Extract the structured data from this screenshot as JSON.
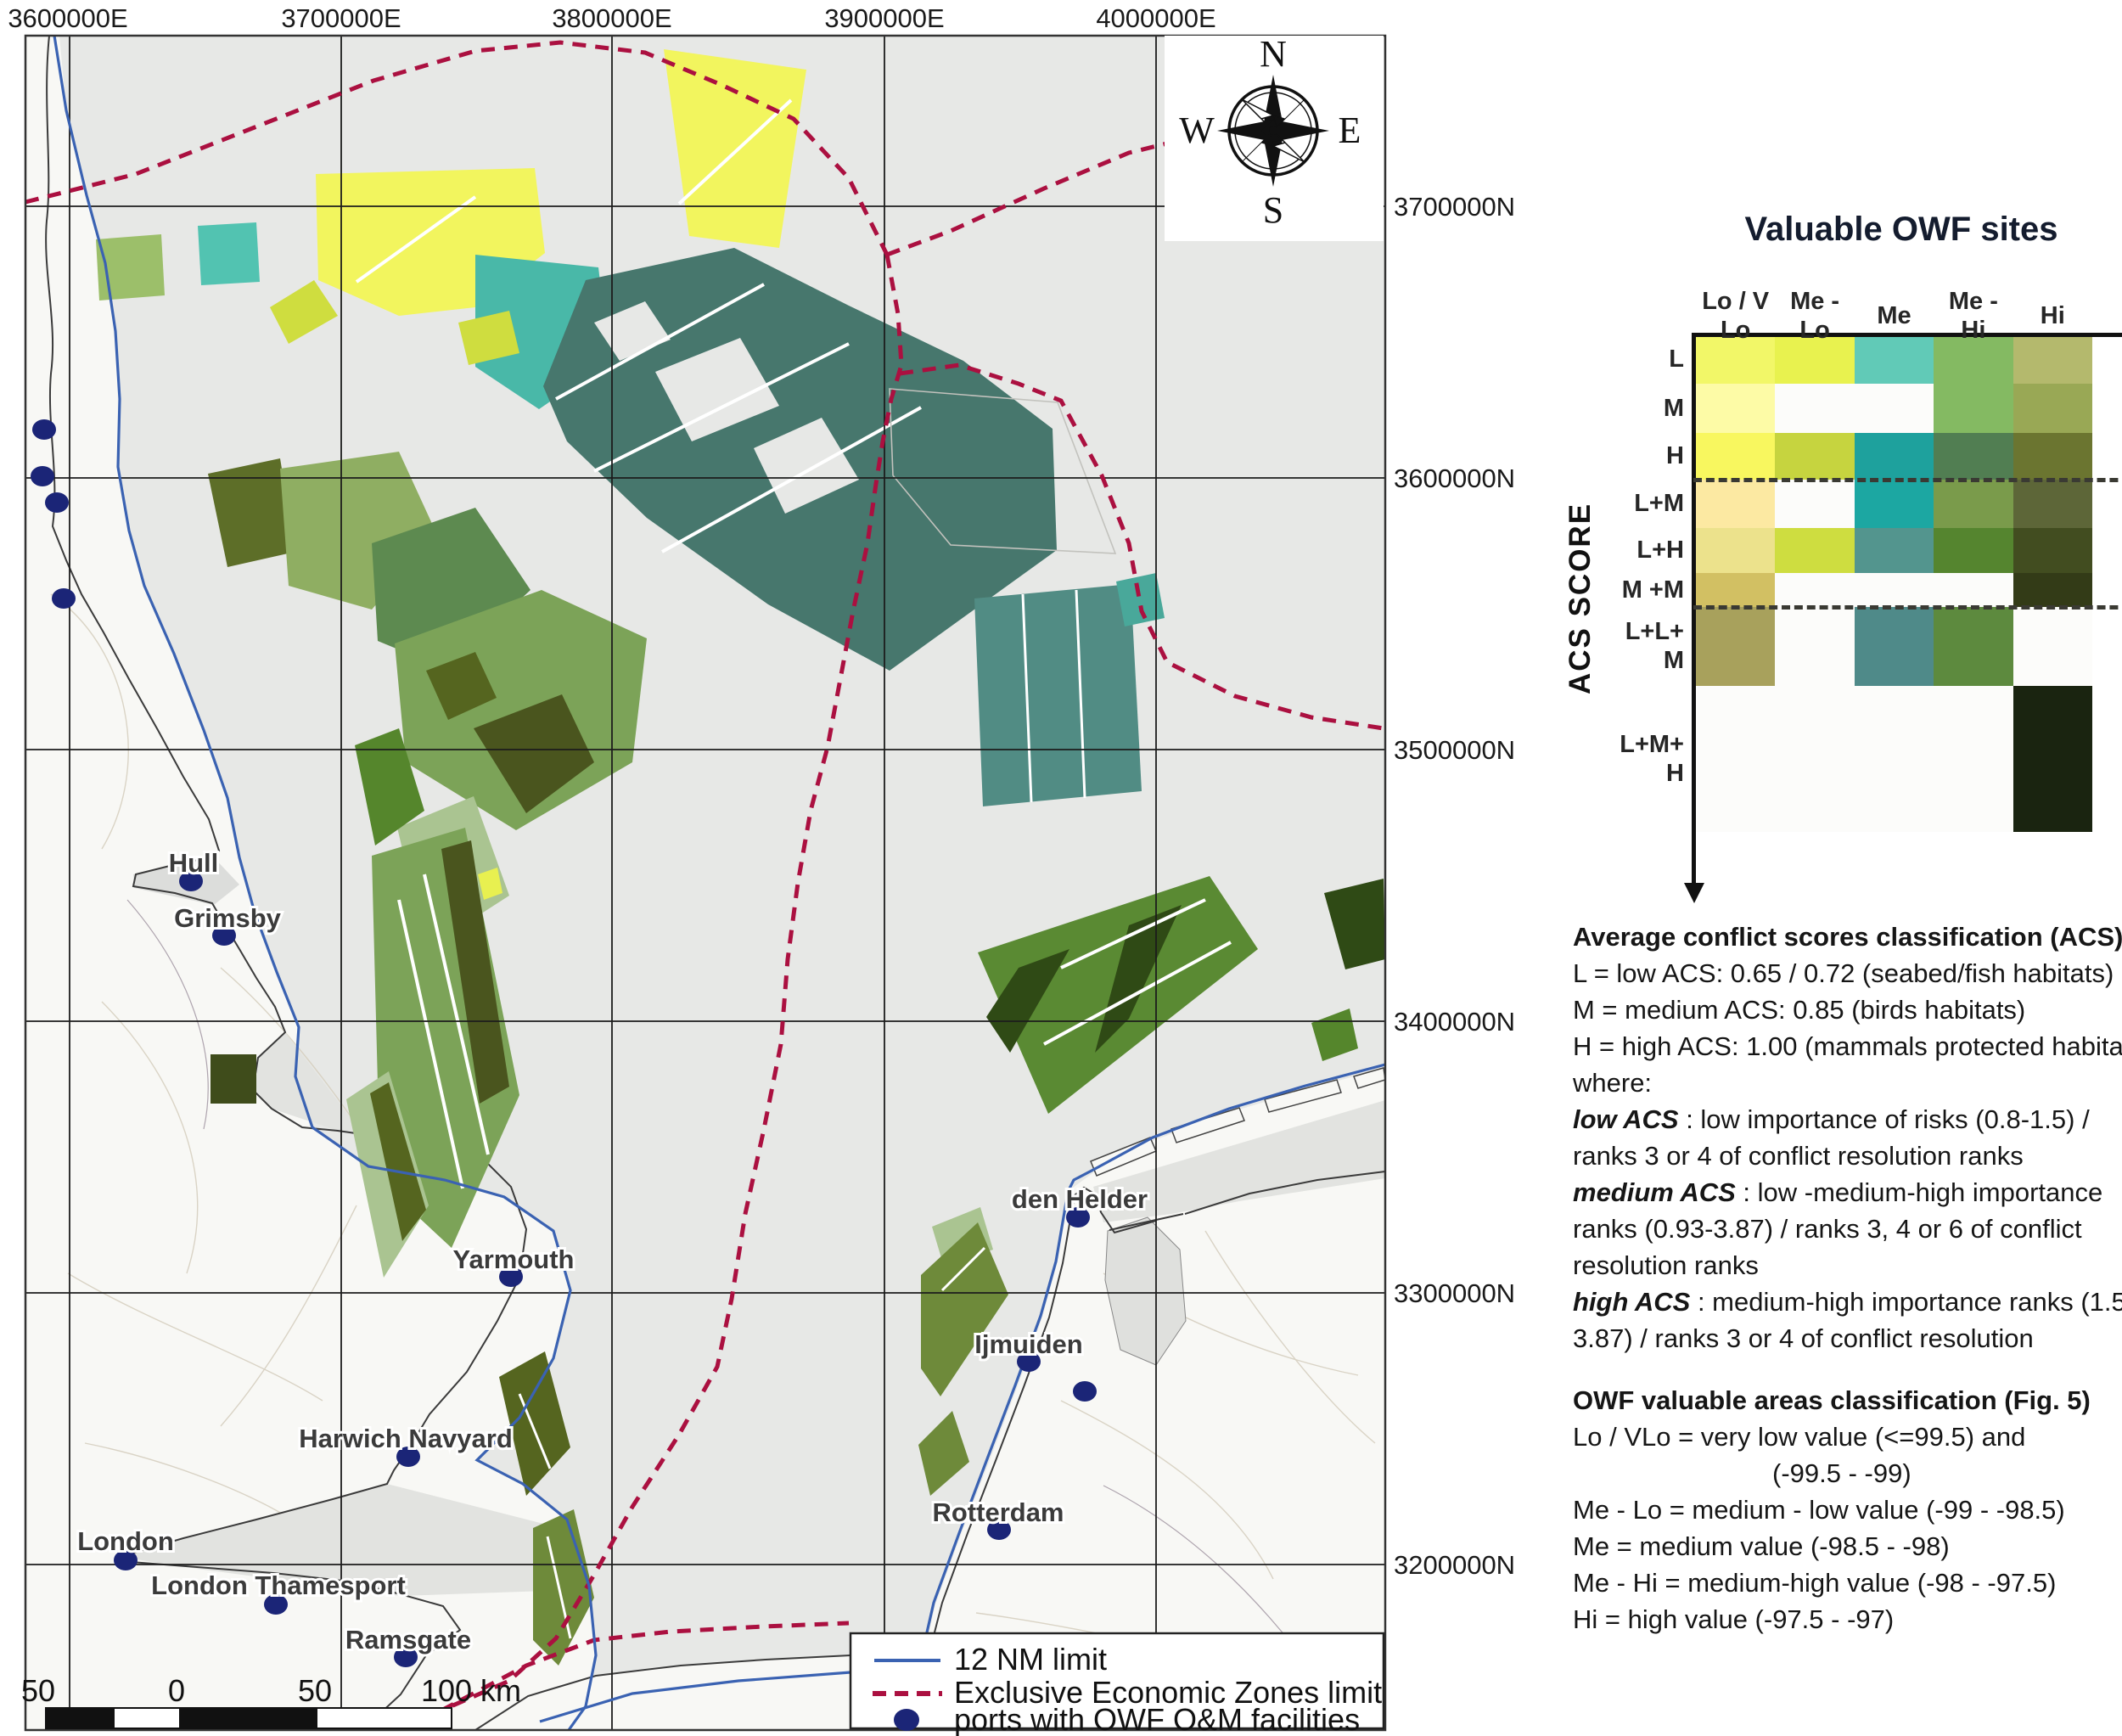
{
  "map": {
    "top_axis": [
      "3600000E",
      "3700000E",
      "3800000E",
      "3900000E",
      "4000000E"
    ],
    "right_axis": [
      "3700000N",
      "3600000N",
      "3500000N",
      "3400000N",
      "3300000N",
      "3200000N"
    ],
    "compass": {
      "n": "N",
      "e": "E",
      "s": "S",
      "w": "W"
    },
    "ports": [
      {
        "name": "Hull",
        "dot": [
          225,
          1038
        ],
        "label": [
          228,
          1027
        ]
      },
      {
        "name": "Grimsby",
        "dot": [
          264,
          1102
        ],
        "label": [
          268,
          1092
        ]
      },
      {
        "name": "Yarmouth",
        "dot": [
          602,
          1504
        ],
        "label": [
          605,
          1494
        ]
      },
      {
        "name": "Harwich Navyard",
        "dot": [
          481,
          1716
        ],
        "label": [
          478,
          1705
        ]
      },
      {
        "name": "London",
        "dot": [
          148,
          1838
        ],
        "label": [
          148,
          1826
        ]
      },
      {
        "name": "London Thamesport",
        "dot": [
          325,
          1890
        ],
        "label": [
          328,
          1878
        ]
      },
      {
        "name": "Ramsgate",
        "dot": [
          478,
          1952
        ],
        "label": [
          481,
          1942
        ]
      },
      {
        "name": "den Helder",
        "dot": [
          1270,
          1434
        ],
        "label": [
          1272,
          1423
        ]
      },
      {
        "name": "Ijmuiden",
        "dot": [
          1212,
          1604
        ],
        "label": [
          1212,
          1594
        ]
      },
      {
        "name": "Rotterdam",
        "dot": [
          1177,
          1802
        ],
        "label": [
          1176,
          1792
        ]
      }
    ],
    "minor_ports": [
      [
        52,
        506
      ],
      [
        50,
        561
      ],
      [
        67,
        592
      ],
      [
        75,
        705
      ],
      [
        1278,
        1639
      ]
    ],
    "legend": {
      "nm_limit": "12 NM limit",
      "eez": "Exclusive Economic Zones limit",
      "ports": "ports with OWF O&M facilities"
    },
    "scalebar": {
      "labels": [
        "50",
        "0",
        "50",
        "100 km"
      ]
    },
    "colors": {
      "sea": "#e7e8e6",
      "land": "#f8f8f5",
      "nm_limit_line": "#3a62b2",
      "eez_line": "#ab1040",
      "port_dot": "#1b2577"
    }
  },
  "panel": {
    "title": "Valuable OWF sites",
    "acs_axis_label": "ACS  SCORE",
    "columns_display": [
      "Lo / V\nLo",
      "Me -\nLo",
      "Me",
      "Me -\nHi",
      "Hi"
    ],
    "rows_display": [
      "L",
      "M",
      "H",
      "L+M",
      "L+H",
      "M +M",
      "L+L+\nM",
      "L+M+\nH"
    ],
    "acs_lines": [
      {
        "runs": [
          {
            "t": "Average conflict scores classification (ACS)",
            "b": true
          }
        ]
      },
      {
        "runs": [
          {
            "t": "L = low ACS: 0.65 / 0.72 (seabed/fish habitats)"
          }
        ]
      },
      {
        "runs": [
          {
            "t": "M = medium ACS: 0.85 (birds habitats)"
          }
        ]
      },
      {
        "runs": [
          {
            "t": "H = high ACS: 1.00 (mammals protected habitats"
          }
        ]
      },
      {
        "runs": [
          {
            "t": "where:"
          }
        ]
      },
      {
        "runs": [
          {
            "t": "low ACS",
            "b": true,
            "i": true
          },
          {
            "t": " : low importance of risks (0.8-1.5) /"
          }
        ]
      },
      {
        "runs": [
          {
            "t": "ranks 3 or 4 of conflict resolution ranks"
          }
        ]
      },
      {
        "runs": [
          {
            "t": "medium ACS",
            "b": true,
            "i": true
          },
          {
            "t": " : low -medium-high importance"
          }
        ]
      },
      {
        "runs": [
          {
            "t": "ranks (0.93-3.87) / ranks 3, 4 or 6 of conflict"
          }
        ]
      },
      {
        "runs": [
          {
            "t": "resolution ranks"
          }
        ]
      },
      {
        "runs": [
          {
            "t": "high ACS",
            "b": true,
            "i": true
          },
          {
            "t": " : medium-high importance ranks (1.5-"
          }
        ]
      },
      {
        "runs": [
          {
            "t": "3.87) / ranks 3 or 4 of conflict resolution"
          }
        ]
      }
    ],
    "owf_lines": [
      {
        "runs": [
          {
            "t": "OWF valuable areas classification (Fig. 5)",
            "b": true
          }
        ]
      },
      {
        "runs": [
          {
            "t": "Lo / VLo = very low value (<=99.5) and"
          }
        ]
      },
      {
        "indent": 235,
        "runs": [
          {
            "t": "(-99.5  - -99)"
          }
        ]
      },
      {
        "runs": [
          {
            "t": "Me - Lo = medium - low value  (-99 - -98.5)"
          }
        ]
      },
      {
        "runs": [
          {
            "t": "Me = medium value (-98.5 - -98)"
          }
        ]
      },
      {
        "runs": [
          {
            "t": "Me - Hi = medium-high value (-98 - -97.5)"
          }
        ]
      },
      {
        "runs": [
          {
            "t": "Hi = high value (-97.5 - -97)"
          }
        ]
      }
    ]
  },
  "chart_data": {
    "type": "heatmap",
    "title": "Valuable OWF sites",
    "xlabel": "OWF value classes",
    "ylabel": "ACS SCORE",
    "columns": [
      "Lo / V Lo",
      "Me - Lo",
      "Me",
      "Me - Hi",
      "Hi"
    ],
    "rows": [
      "L",
      "M",
      "H",
      "L+M",
      "L+H",
      "M +M",
      "L+L+ M",
      "L+M+ H"
    ],
    "cell_colors": [
      [
        "#f2f768",
        "#e8f24f",
        "#61cab7",
        "#84ba62",
        "#b4b96d"
      ],
      [
        "#fdfba6",
        "#fcfcfa",
        "#fcfcfa",
        "#84ba62",
        "#99a855"
      ],
      [
        "#f8f75f",
        "#c6d43f",
        "#1ea19d",
        "#517e52",
        "#6b7530"
      ],
      [
        "#fce9a2",
        "#fcfcfa",
        "#1ca7a2",
        "#7a9b4b",
        "#5d6638"
      ],
      [
        "#ece28c",
        "#cedd40",
        "#53958e",
        "#55852f",
        "#424d20"
      ],
      [
        "#d2c063",
        "#fcfcfa",
        "#fcfcfa",
        "#fcfcfa",
        "#333b17"
      ],
      [
        "#a8a15c",
        "#fcfcfa",
        "#4f8a89",
        "#5d8a3e",
        "#fcfcfa"
      ],
      [
        "#fcfcfa",
        "#fcfcfa",
        "#fcfcfa",
        "#fcfcfa",
        "#1a2410"
      ]
    ],
    "dashed_separators_after_rows": [
      "H",
      "M +M"
    ],
    "legend_position": "right-panel",
    "grid": false
  }
}
